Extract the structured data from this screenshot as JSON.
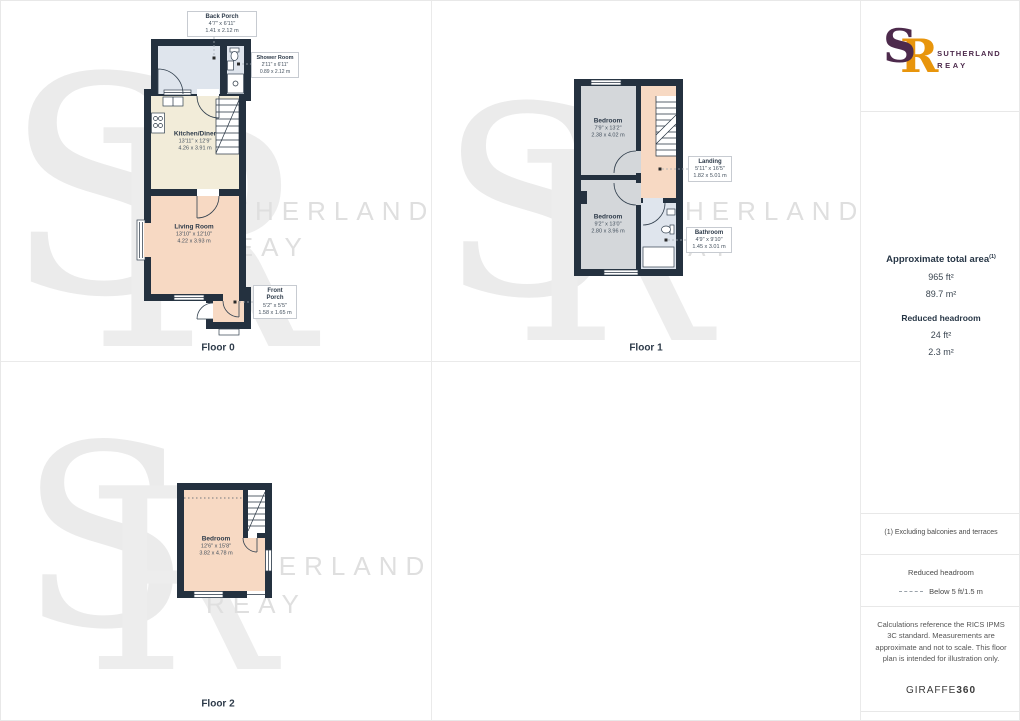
{
  "branding": {
    "monogram_s": "S",
    "monogram_r": "R",
    "name_line1": "SUTHERLAND",
    "name_line2": "REAY",
    "purple": "#4D2A4C",
    "orange": "#E8950C"
  },
  "watermark": {
    "s": "S",
    "r": "R",
    "line1": "SUTHERLAND",
    "line2": "REAY"
  },
  "floors": [
    {
      "label": "Floor 0",
      "rooms": {
        "back_porch": {
          "name": "Back Porch",
          "ft": "4'7\" x 6'11\"",
          "m": "1.41 x 2.12 m"
        },
        "shower_room": {
          "name": "Shower Room",
          "ft": "2'11\" x 6'11\"",
          "m": "0.89 x 2.12 m"
        },
        "kitchen": {
          "name": "Kitchen/Diner",
          "ft": "13'11\" x 12'9\"",
          "m": "4.26 x 3.91 m"
        },
        "living": {
          "name": "Living Room",
          "ft": "13'10\" x 12'10\"",
          "m": "4.22 x 3.93 m"
        },
        "front_porch": {
          "name": "Front Porch",
          "ft": "5'2\" x 5'5\"",
          "m": "1.58 x 1.65 m"
        }
      }
    },
    {
      "label": "Floor 1",
      "rooms": {
        "bedroom_top": {
          "name": "Bedroom",
          "ft": "7'9\" x 13'2\"",
          "m": "2.38 x 4.02 m"
        },
        "landing": {
          "name": "Landing",
          "ft": "5'11\" x 16'5\"",
          "m": "1.82 x 5.01 m"
        },
        "bedroom_bottom": {
          "name": "Bedroom",
          "ft": "9'2\" x 13'0\"",
          "m": "2.80 x 3.96 m"
        },
        "bathroom": {
          "name": "Bathroom",
          "ft": "4'9\" x 9'10\"",
          "m": "1.45 x 3.01 m"
        }
      }
    },
    {
      "label": "Floor 2",
      "rooms": {
        "bedroom": {
          "name": "Bedroom",
          "ft": "12'6\" x 15'8\"",
          "m": "3.82 x 4.78 m"
        }
      }
    }
  ],
  "sidebar": {
    "total_area_label": "Approximate total area",
    "total_area_sup": "(1)",
    "total_area_ft": "965 ft²",
    "total_area_m": "89.7 m²",
    "reduced_headroom_label": "Reduced headroom",
    "reduced_headroom_ft": "24 ft²",
    "reduced_headroom_m": "2.3 m²",
    "note": "(1) Excluding balconies and terraces",
    "legend_title": "Reduced headroom",
    "legend_value": "Below 5 ft/1.5 m",
    "disclaimer": "Calculations reference the RICS IPMS 3C standard. Measurements are approximate and not to scale. This floor plan is intended for illustration only.",
    "footer_name": "GIRAFFE",
    "footer_number": "360"
  },
  "colors": {
    "wall": "#24313F",
    "kitchen_floor": "#F2ECD9",
    "living_floor": "#F7D9C3",
    "bedroom_floor_gray": "#D4D7DA",
    "wet_room_floor": "#DFE5ED",
    "watermark_gray": "#EBEBEB"
  }
}
